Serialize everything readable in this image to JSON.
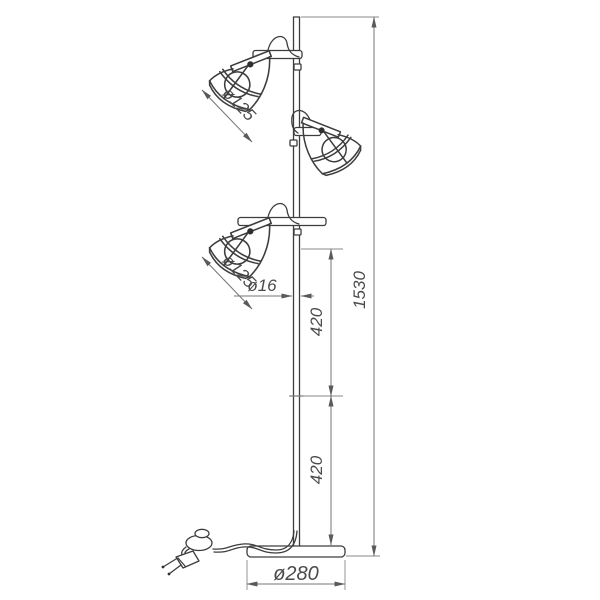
{
  "drawing": {
    "kind": "technical line drawing of a three-head floor lamp",
    "background": "#ffffff",
    "object_line_color": "#3d3d3d",
    "dimension_line_color": "#757575",
    "labels": {
      "top_shade_diameter": "ø125",
      "lower_shade_diameter": "ø125",
      "pole_diameter": "ø16",
      "upper_segment": "420",
      "lower_segment": "420",
      "total_height": "1530",
      "base_diameter": "ø280"
    }
  }
}
